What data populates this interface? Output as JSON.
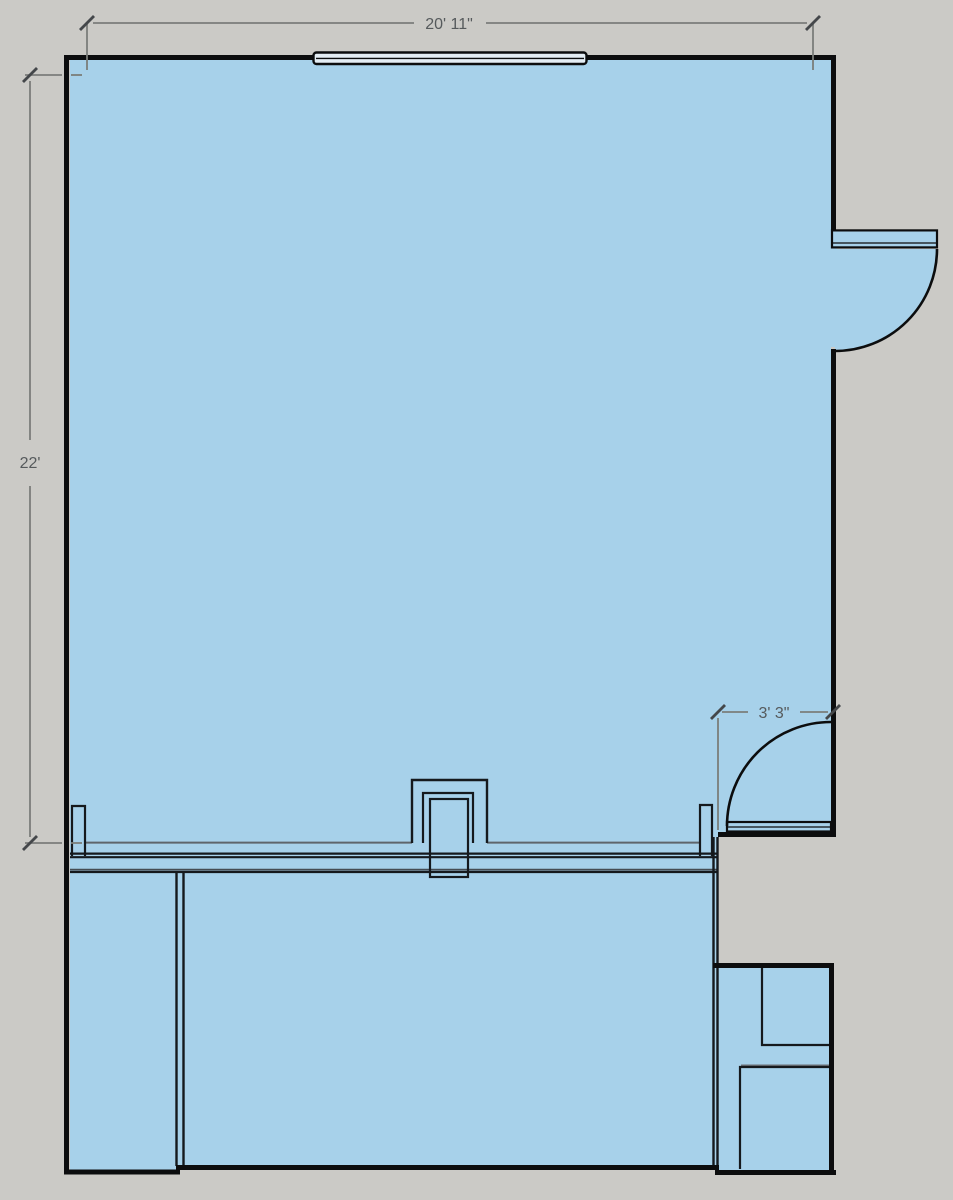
{
  "drawing": {
    "type": "floor-plan",
    "style": "sketchup-plan-view"
  },
  "colors": {
    "background": "#cbcac6",
    "floor": "#a7d1ea",
    "wall": "#0c0d0e",
    "interior_line": "#15191d",
    "ledge_line": "#5e656b",
    "dimension_line": "#7b7d7a",
    "dimension_text": "#565a5c",
    "window_fill": "#e4edf4"
  },
  "dimensions": {
    "top_width": {
      "label": "20' 11\"",
      "orientation": "horizontal"
    },
    "left_height": {
      "label": "22'",
      "orientation": "vertical"
    },
    "lower_door": {
      "label": "3' 3\"",
      "orientation": "horizontal"
    }
  },
  "features": {
    "window_count": 1,
    "door_count": 2,
    "door_swing": "quarter-circle arcs"
  }
}
